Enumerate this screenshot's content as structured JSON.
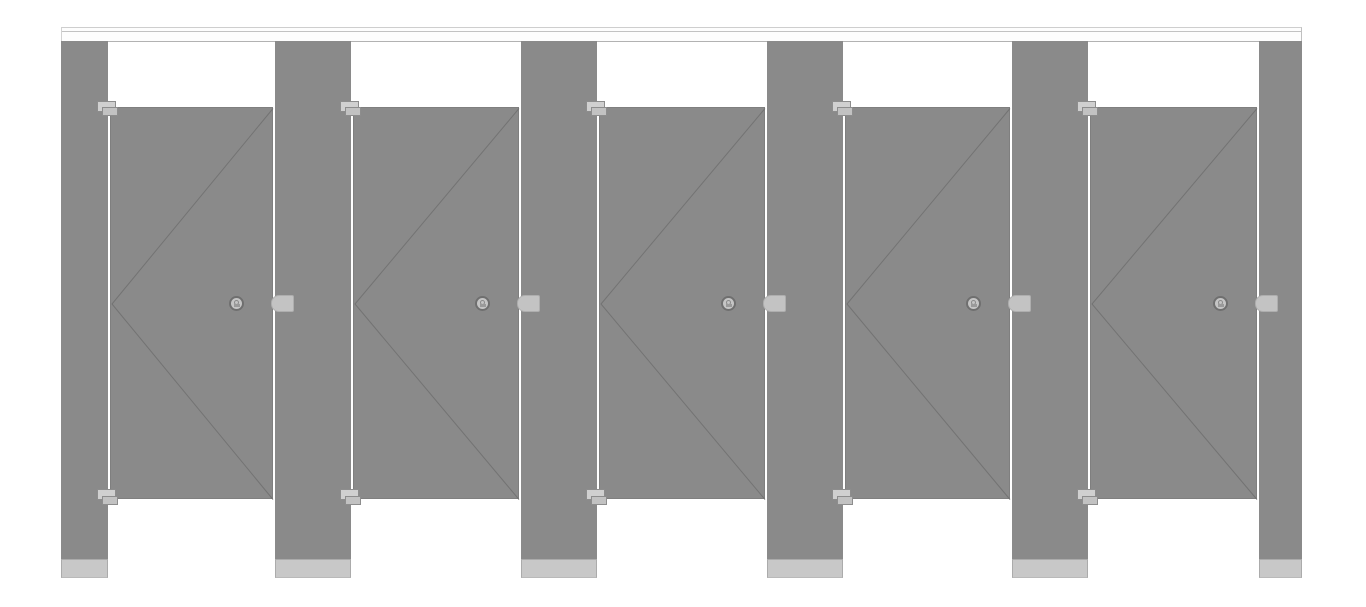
{
  "scene": {
    "description": "Front elevation of five toilet partition cubicles, floor-anchored headrail-braced",
    "canvas": {
      "width": 1366,
      "height": 607,
      "background": "#ffffff"
    },
    "headrail": {
      "x": 61,
      "y": 27,
      "width": 1241,
      "height": 15
    },
    "pilaster_top": 41,
    "pilaster_bottom": 578,
    "door_top": 107,
    "door_bottom": 499,
    "shoe_height": 19,
    "pilasters": [
      {
        "x": 61,
        "w": 47
      },
      {
        "x": 275,
        "w": 76
      },
      {
        "x": 521,
        "w": 76
      },
      {
        "x": 767,
        "w": 76
      },
      {
        "x": 1012,
        "w": 76
      },
      {
        "x": 1259,
        "w": 43
      }
    ],
    "doors": [
      {
        "x": 110,
        "w": 163
      },
      {
        "x": 353,
        "w": 166
      },
      {
        "x": 599,
        "w": 166
      },
      {
        "x": 845,
        "w": 165
      },
      {
        "x": 1090,
        "w": 167
      }
    ],
    "hardware": {
      "hinge_back": {
        "dx": -14,
        "w": 19,
        "h": 11
      },
      "hinge_front": {
        "dx": -9,
        "w": 16,
        "h": 9
      },
      "knob": {
        "right_offset": 29,
        "size": 15
      },
      "keeper": {
        "right_offset": -8,
        "w": 23,
        "h": 17
      }
    },
    "colors": {
      "panel_gray": "#8a8a8a",
      "panel_edge": "#7f7f7f",
      "swing_line": "#737373",
      "gap_white": "#ffffff",
      "headrail_fill": "#fdfdfd",
      "headrail_line": "#c2c2c2",
      "shoe_fill": "#c8c8c8",
      "hinge_back_fill": "#d0d0d0",
      "hinge_front_fill": "#c2c2c2",
      "knob_fill": "#c5c5c5",
      "keeper_fill": "#c3c3c3"
    }
  }
}
